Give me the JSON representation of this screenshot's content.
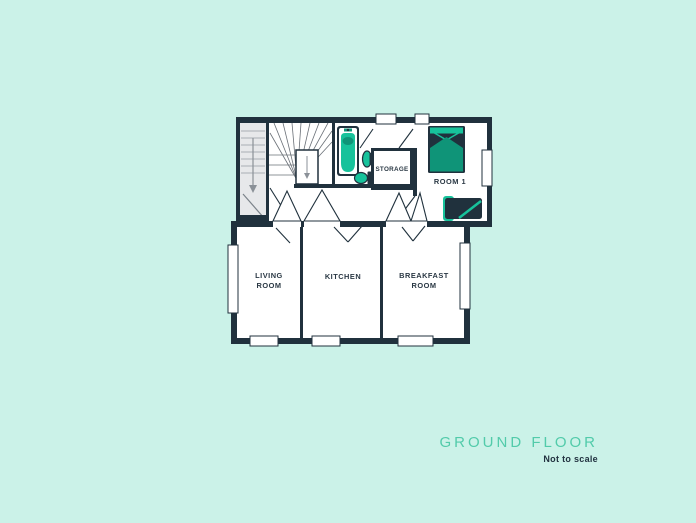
{
  "page": {
    "background_color": "#cbf2e8"
  },
  "plan": {
    "labels": {
      "living_line1": "LIVING",
      "living_line2": "ROOM",
      "kitchen": "KITCHEN",
      "breakfast_line1": "BREAKFAST",
      "breakfast_line2": "ROOM",
      "room1": "ROOM 1",
      "storage": "STORAGE"
    },
    "icons": [
      "bathtub-icon",
      "sink-icon",
      "toilet-icon",
      "bed-icon",
      "sofa-icon",
      "stairs-down-arrow-icon",
      "winder-stairs",
      "door-swing",
      "window"
    ],
    "colors": {
      "wall": "#20313d",
      "room_fill": "#ffffff",
      "stair_fill": "#e7e8ea",
      "stair_line": "#a9aeb4",
      "fixture_teal": "#17c29b",
      "fixture_teal_dark": "#0f9478",
      "label_text": "#2a3844"
    }
  },
  "footer": {
    "title": "GROUND FLOOR",
    "subtitle": "Not to scale",
    "title_color": "#52cbaa",
    "subtitle_color": "#223240"
  }
}
